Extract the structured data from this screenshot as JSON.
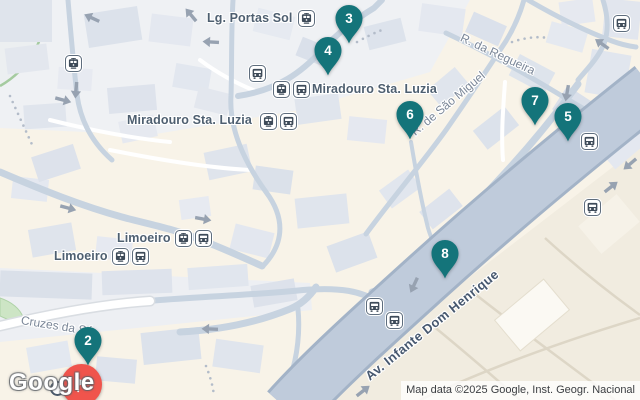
{
  "map": {
    "place_labels": [
      {
        "text": "Lg. Portas Sol",
        "icons": [
          "tram"
        ]
      },
      {
        "text": "Miradouro Sta. Luzia",
        "icons": [
          "tram",
          "bus"
        ]
      },
      {
        "text": "Miradouro Sta. Luzia",
        "icons": [
          "tram",
          "bus"
        ]
      },
      {
        "text": "Limoeiro",
        "icons": [
          "tram",
          "bus"
        ]
      },
      {
        "text": "Limoeiro",
        "icons": [
          "tram",
          "bus"
        ]
      }
    ],
    "street_labels": [
      "Cruzes da Sé",
      "R. da Regueira",
      "R. de São Miguel",
      "Av. Infante Dom Henrique"
    ],
    "markers": [
      {
        "label": "2"
      },
      {
        "label": "3"
      },
      {
        "label": "4"
      },
      {
        "label": "5"
      },
      {
        "label": "6"
      },
      {
        "label": "7"
      },
      {
        "label": "8"
      }
    ],
    "marker_color": "#14747A",
    "transit_stops": [
      "tram",
      "bus",
      "bus",
      "bus",
      "bus",
      "bus",
      "bus"
    ],
    "destination_marker": {
      "icon": "flag",
      "color": "#F0544C"
    }
  },
  "attribution": {
    "logo": "Google",
    "map_data": "Map data ©2025 Google, Inst. Geogr. Nacional"
  }
}
